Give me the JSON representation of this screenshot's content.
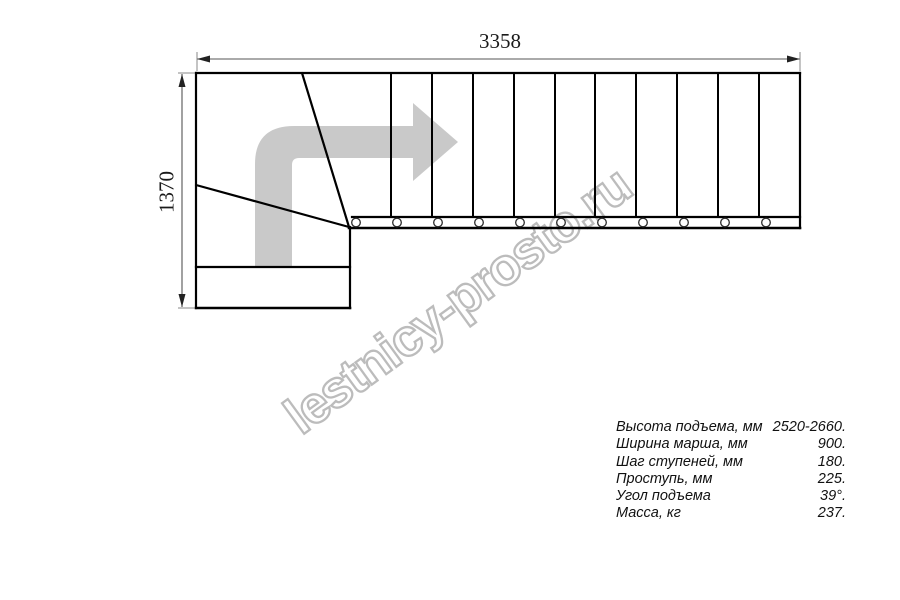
{
  "dimensions": {
    "width_mm": "3358",
    "height_mm": "1370"
  },
  "watermark": {
    "text": "lestnicy-prosto.ru"
  },
  "specs": {
    "rows": [
      {
        "label": "Высота подъема, мм",
        "value": "2520-2660."
      },
      {
        "label": "Ширина марша, мм",
        "value": "900."
      },
      {
        "label": "Шаг ступеней, мм",
        "value": "180."
      },
      {
        "label": "Проступь, мм",
        "value": "225."
      },
      {
        "label": "Угол подъема",
        "value": "39°."
      },
      {
        "label": "Масса, кг",
        "value": "237."
      }
    ]
  },
  "colors": {
    "line": "#000000",
    "dimension_line": "#555555",
    "arrow_fill": "#c9c9c9",
    "watermark_outline": "#bcbcbc",
    "background": "#ffffff"
  }
}
